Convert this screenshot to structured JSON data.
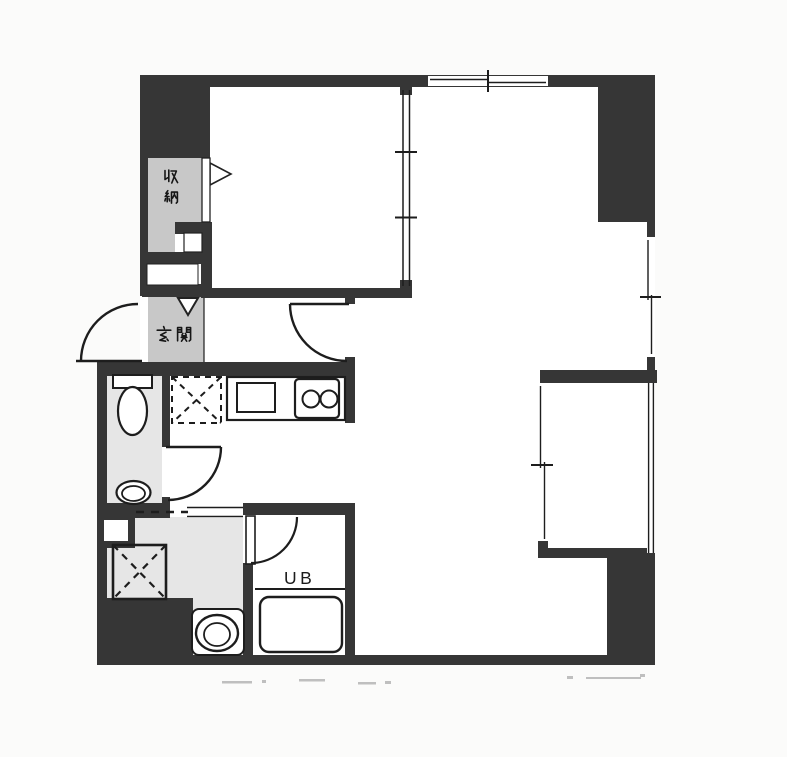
{
  "document": {
    "kind": "scanned apartment floor plan"
  },
  "labels": {
    "storage": "収納",
    "entrance": "玄関",
    "unit_bath": "UB"
  },
  "colors": {
    "wall": "#363636",
    "room_fill": "#c8c8c8",
    "wet_area_floor": "#e6e6e6",
    "line": "#1d1d1d",
    "paper": "#fbfbfa"
  },
  "fixtures": [
    "toilet-icon",
    "hand-basin-icon",
    "kitchen-sink-icon",
    "gas-stove-icon",
    "refrigerator-space-icon",
    "washing-machine-space-icon",
    "washbasin-icon",
    "bathtub-icon",
    "door-swing-icon",
    "sliding-window-icon"
  ]
}
